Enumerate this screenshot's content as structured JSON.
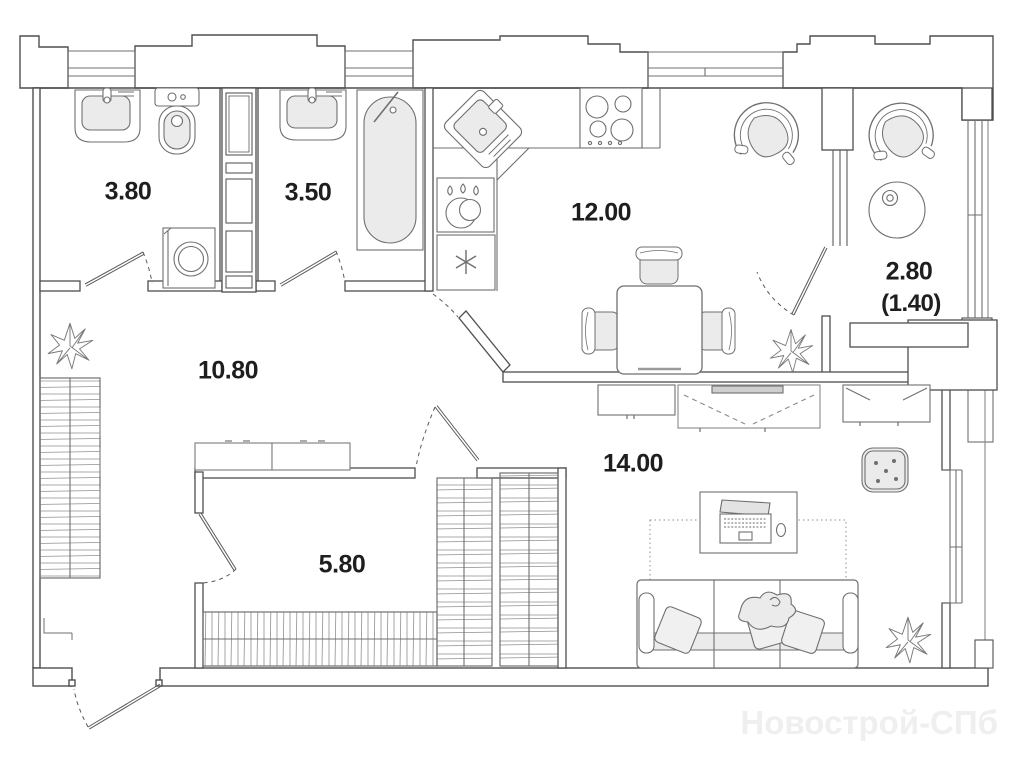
{
  "plan": {
    "type": "apartment-floor-plan",
    "watermark": {
      "text": "Новострой-СПб",
      "color": "#efefef"
    },
    "rooms": [
      {
        "id": "bathroom-1",
        "kind": "bathroom",
        "area_label": "3.80"
      },
      {
        "id": "bathroom-2",
        "kind": "bathroom",
        "area_label": "3.50"
      },
      {
        "id": "kitchen",
        "kind": "kitchen",
        "area_label": "12.00"
      },
      {
        "id": "balcony",
        "kind": "balcony",
        "area_label": "2.80",
        "area_label_reduced": "(1.40)"
      },
      {
        "id": "hallway",
        "kind": "hallway",
        "area_label": "10.80"
      },
      {
        "id": "dressing-room",
        "kind": "wardrobe-room",
        "area_label": "5.80"
      },
      {
        "id": "living-room",
        "kind": "living-room",
        "area_label": "14.00"
      }
    ],
    "fixtures": [
      {
        "name": "sink-icon"
      },
      {
        "name": "toilet-icon"
      },
      {
        "name": "washing-machine-icon"
      },
      {
        "name": "bathtub-icon"
      },
      {
        "name": "kitchen-corner-sink-icon"
      },
      {
        "name": "stove-icon"
      },
      {
        "name": "water-heater-icon"
      },
      {
        "name": "vent-shaft-icon"
      },
      {
        "name": "dining-table-icon"
      },
      {
        "name": "chair-icon"
      },
      {
        "name": "armchair-icon"
      },
      {
        "name": "round-table-icon"
      },
      {
        "name": "wardrobe-hangers-icon"
      },
      {
        "name": "plant-icon"
      },
      {
        "name": "sofa-icon"
      },
      {
        "name": "pillow-icon"
      },
      {
        "name": "blanket-icon"
      },
      {
        "name": "desk-icon"
      },
      {
        "name": "laptop-icon"
      },
      {
        "name": "mouse-icon"
      },
      {
        "name": "pouf-icon"
      },
      {
        "name": "tv-stand-icon"
      },
      {
        "name": "rug-icon"
      },
      {
        "name": "door-swing-icon"
      },
      {
        "name": "window-icon"
      }
    ],
    "colors": {
      "background": "#ffffff",
      "wall_line": "#4f4f4f",
      "furniture_line": "#6f6f6f",
      "hatch_line": "#8f8f8f",
      "fill_light": "#ebebeb",
      "label_text": "#1e1e1e",
      "watermark": "#efefef"
    }
  }
}
